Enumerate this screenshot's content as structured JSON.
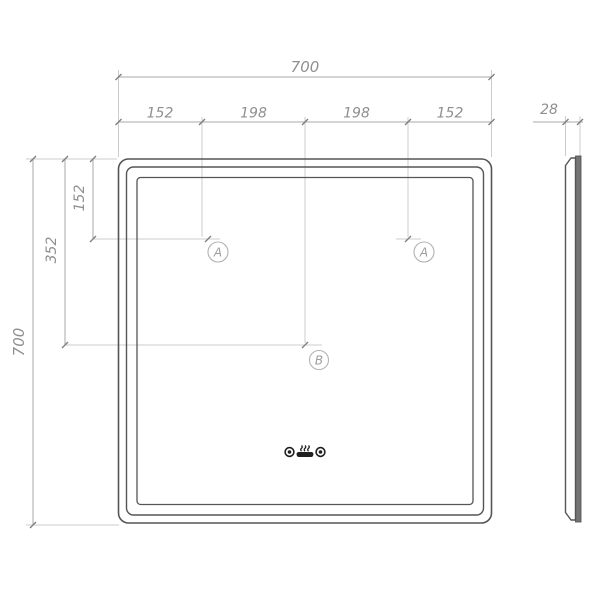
{
  "front_view": {
    "overall_width": "700",
    "overall_height": "700",
    "top_segments": [
      "152",
      "198",
      "198",
      "152"
    ],
    "left_offset_small": "152",
    "left_offset_large": "352",
    "markers": {
      "left": "A",
      "right": "A",
      "center": "B"
    }
  },
  "side_view": {
    "thickness": "28"
  },
  "icons": {
    "left": "touch-sensor",
    "center": "anti-fog",
    "right": "touch-sensor"
  },
  "colors": {
    "outline": "#555555",
    "dimension_line": "#a8a8a8",
    "extension_line": "#cccccc",
    "dimension_text": "#8f8f8f",
    "marker": "#9d9d9d",
    "icon": "#1f1f1f",
    "side_glass_fill": "#757575",
    "background": "#ffffff"
  }
}
